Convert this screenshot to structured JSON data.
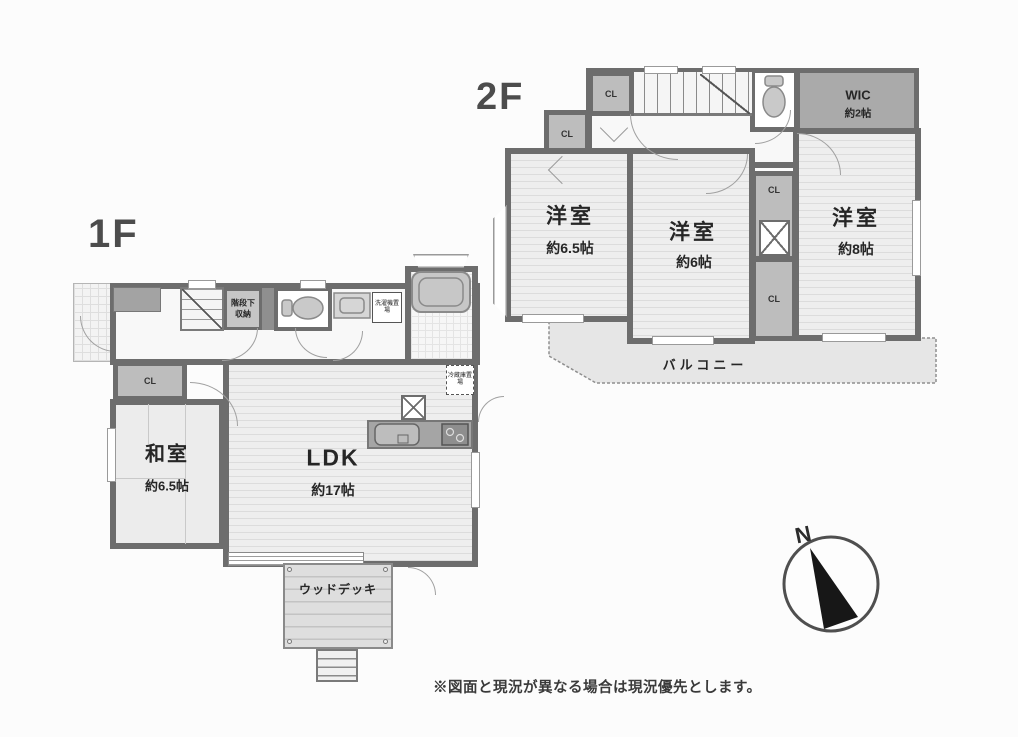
{
  "floor1": {
    "label": "1F",
    "rooms": [
      {
        "name": "和室",
        "size": "約6.5帖"
      },
      {
        "name": "LDK",
        "size": "約17帖"
      }
    ],
    "closets": [
      "CL",
      "CL",
      "CL"
    ],
    "stair_storage_line1": "階段下",
    "stair_storage_line2": "収納",
    "laundry_label": "洗濯機置場",
    "fridge_label": "冷蔵庫置場",
    "wood_deck_label": "ウッドデッキ"
  },
  "floor2": {
    "label": "2F",
    "rooms": [
      {
        "name": "洋室",
        "size": "約6.5帖"
      },
      {
        "name": "洋室",
        "size": "約6帖"
      },
      {
        "name": "洋室",
        "size": "約8帖"
      },
      {
        "name": "WIC",
        "size": "約2帖"
      }
    ],
    "closets": [
      "CL",
      "CL",
      "CL",
      "CL"
    ],
    "balcony_label": "バルコニー"
  },
  "compass": {
    "north_label": "N"
  },
  "footnote": "※図面と現況が異なる場合は現況優先とします。",
  "colors": {
    "wall": "#6d6d6d",
    "closet": "#bdbdbd",
    "wic": "#aaaaaa",
    "balcony": "#e6e6e6",
    "text": "#2e2e2e"
  }
}
